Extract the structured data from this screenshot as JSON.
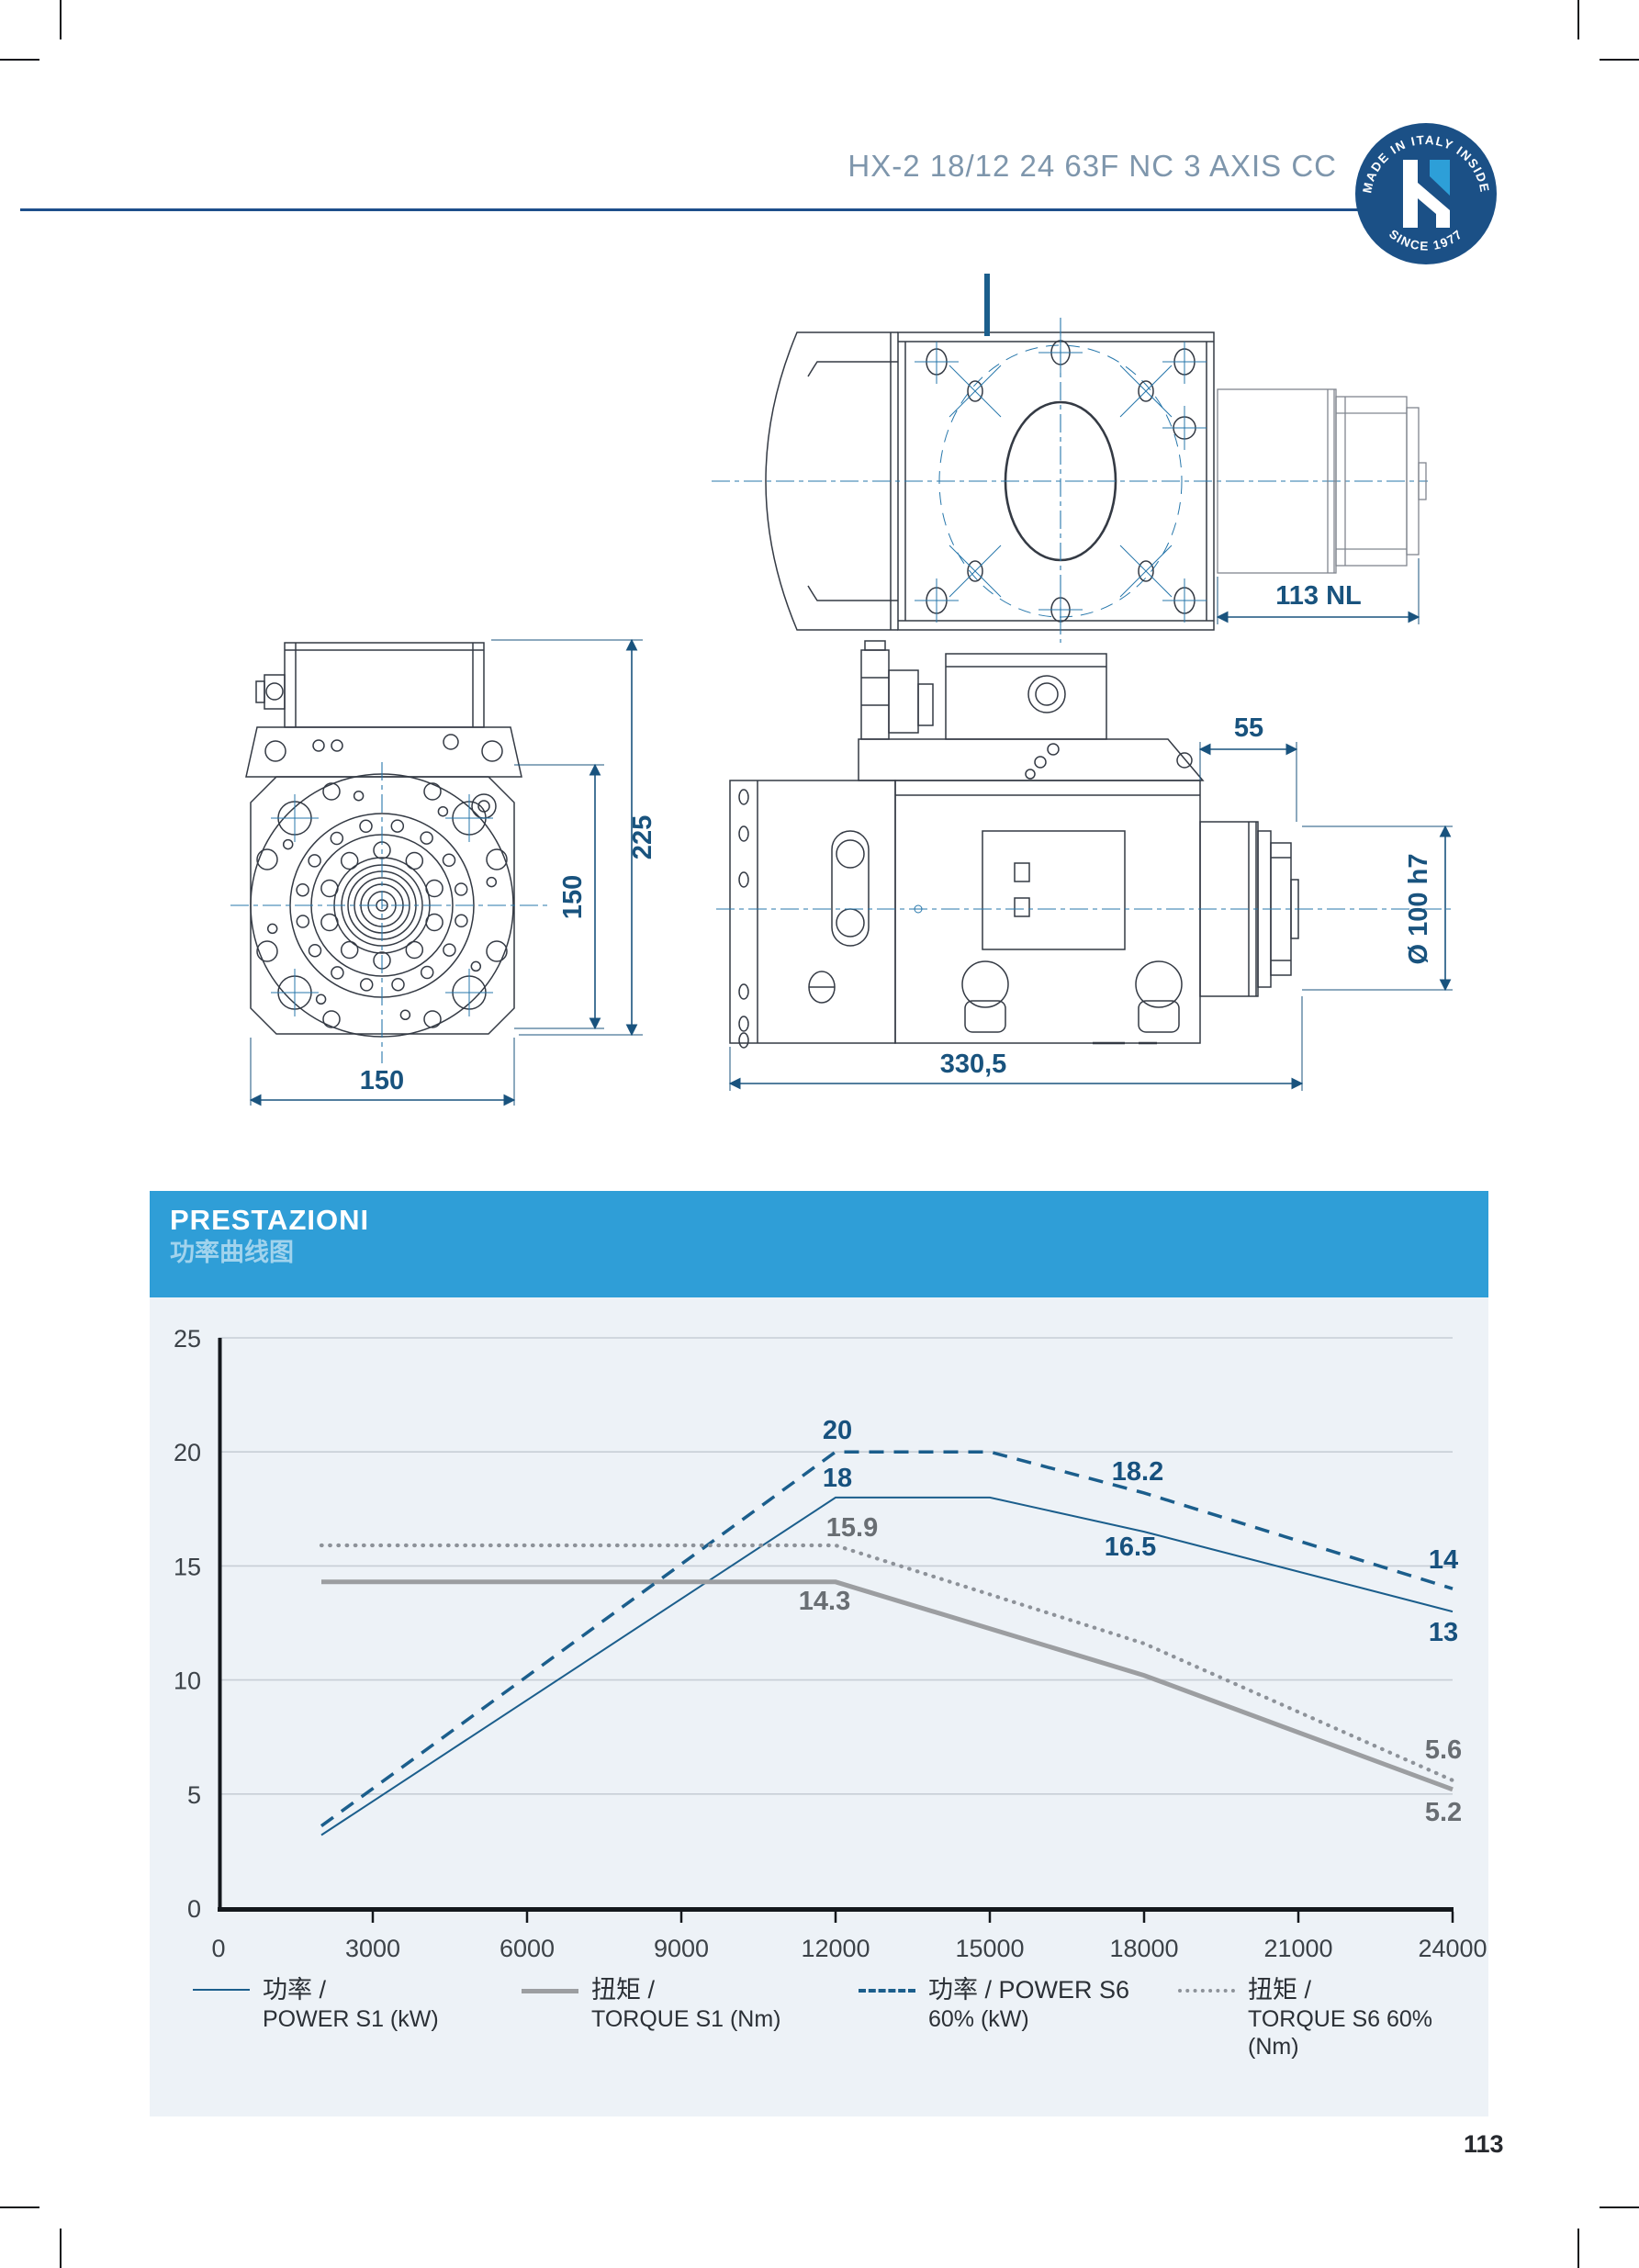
{
  "header": {
    "title": "HX-2 18/12 24 63F NC 3 AXIS CC",
    "badge": {
      "arc_top": "MADE IN ITALY INSIDE",
      "arc_bottom": "SINCE 1977"
    }
  },
  "drawings": {
    "top_view": {
      "dim_motor_length": "113 NL"
    },
    "front_view": {
      "dim_total_height": "225",
      "dim_flange_height": "150",
      "dim_width": "150"
    },
    "side_view": {
      "dim_spindle_offset": "55",
      "dim_shaft": "Ø 100 h7",
      "dim_length": "330,5"
    }
  },
  "panel": {
    "title": "PRESTAZIONI",
    "subtitle": "功率曲线图"
  },
  "chart_data": {
    "type": "line",
    "title": "PRESTAZIONI / 功率曲线图",
    "xlabel": "rpm",
    "ylabel": "kW / Nm",
    "xlim": [
      0,
      24000
    ],
    "ylim": [
      0,
      25
    ],
    "x_ticks": [
      0,
      3000,
      6000,
      9000,
      12000,
      15000,
      18000,
      21000,
      24000
    ],
    "y_ticks": [
      0,
      5,
      10,
      15,
      20,
      25
    ],
    "grid": "horizontal",
    "legend_position": "bottom",
    "series": [
      {
        "name": "功率 / POWER S1 (kW)",
        "style": "solid-thin",
        "color": "#1b5e8c",
        "points": [
          [
            2000,
            3.2
          ],
          [
            12000,
            18
          ],
          [
            15000,
            18
          ],
          [
            18000,
            16.5
          ],
          [
            24000,
            13
          ]
        ]
      },
      {
        "name": "扭矩 / TORQUE S1 (Nm)",
        "style": "solid-thick",
        "color": "#9c9ea1",
        "points": [
          [
            2000,
            14.3
          ],
          [
            12000,
            14.3
          ],
          [
            18000,
            10.2
          ],
          [
            24000,
            5.2
          ]
        ]
      },
      {
        "name": "功率 / POWER S6 60% (kW)",
        "style": "dashed",
        "color": "#1b5e8c",
        "points": [
          [
            2000,
            3.6
          ],
          [
            12000,
            20
          ],
          [
            15000,
            20
          ],
          [
            18000,
            18.2
          ],
          [
            24000,
            14
          ]
        ]
      },
      {
        "name": "扭矩 / TORQUE S6 60% (Nm)",
        "style": "dotted",
        "color": "#8d9299",
        "points": [
          [
            2000,
            15.9
          ],
          [
            12000,
            15.9
          ],
          [
            18000,
            11.6
          ],
          [
            24000,
            5.6
          ]
        ]
      }
    ],
    "annotations": [
      {
        "text": "20",
        "rpm": 12000,
        "value": 20,
        "color": "#17517e",
        "dx": 2,
        "dy": -14,
        "anchor": "middle"
      },
      {
        "text": "18",
        "rpm": 12000,
        "value": 18,
        "color": "#17517e",
        "dx": 2,
        "dy": -12,
        "anchor": "middle"
      },
      {
        "text": "15.9",
        "rpm": 12000,
        "value": 15.9,
        "color": "#696e73",
        "dx": 18,
        "dy": -10,
        "anchor": "middle"
      },
      {
        "text": "14.3",
        "rpm": 12000,
        "value": 14.3,
        "color": "#696e73",
        "dx": -12,
        "dy": 30,
        "anchor": "middle"
      },
      {
        "text": "18.2",
        "rpm": 18000,
        "value": 18.2,
        "color": "#17517e",
        "dx": -7,
        "dy": -14,
        "anchor": "middle"
      },
      {
        "text": "16.5",
        "rpm": 18000,
        "value": 16.5,
        "color": "#17517e",
        "dx": -15,
        "dy": 26,
        "anchor": "middle"
      },
      {
        "text": "14",
        "rpm": 24000,
        "value": 14,
        "color": "#17517e",
        "dx": -10,
        "dy": -22,
        "anchor": "middle"
      },
      {
        "text": "13",
        "rpm": 24000,
        "value": 13,
        "color": "#17517e",
        "dx": -10,
        "dy": 32,
        "anchor": "middle"
      },
      {
        "text": "5.6",
        "rpm": 24000,
        "value": 5.6,
        "color": "#696e73",
        "dx": -10,
        "dy": -24,
        "anchor": "middle"
      },
      {
        "text": "5.2",
        "rpm": 24000,
        "value": 5.2,
        "color": "#696e73",
        "dx": -10,
        "dy": 34,
        "anchor": "middle"
      }
    ]
  },
  "legend": {
    "items": [
      {
        "line1": "功率 /",
        "line2": "POWER S1 (kW)",
        "style": "solid-thin"
      },
      {
        "line1": "扭矩 /",
        "line2": "TORQUE S1 (Nm)",
        "style": "solid-thick"
      },
      {
        "line1": "功率 / POWER S6",
        "line2": "60% (kW)",
        "style": "dashed"
      },
      {
        "line1": "扭矩 /",
        "line2": "TORQUE S6 60% (Nm)",
        "style": "dotted"
      }
    ]
  },
  "page": {
    "number": "113"
  }
}
